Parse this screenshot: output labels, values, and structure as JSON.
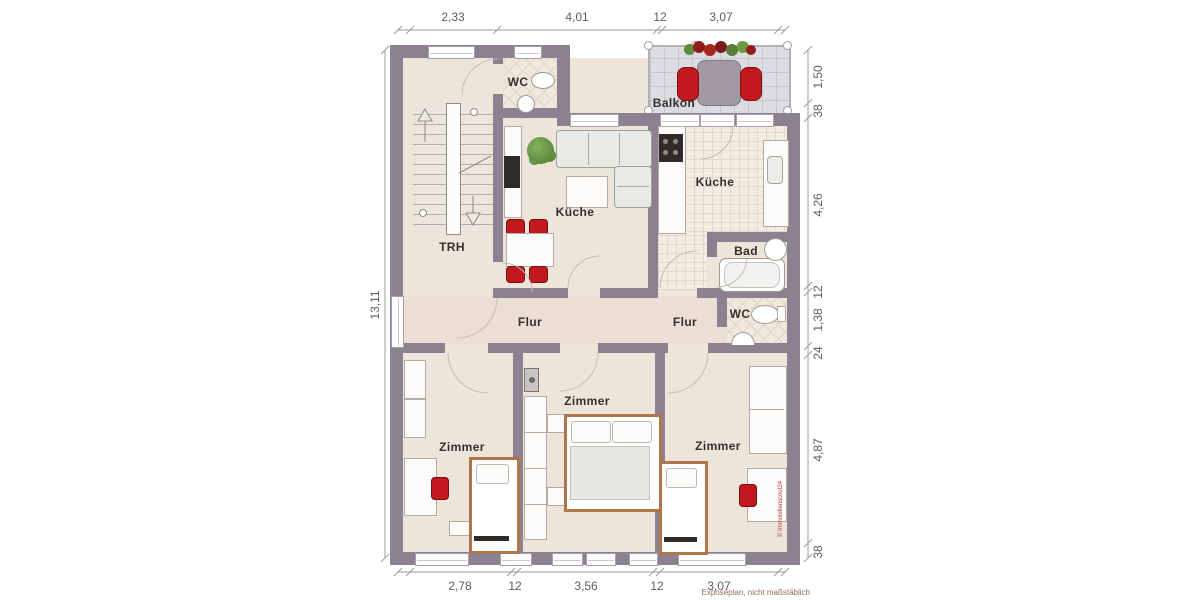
{
  "plan": {
    "rooms": {
      "balkon": "Balkon",
      "wc_top": "WC",
      "kueche_left": "Küche",
      "kueche_right": "Küche",
      "bad": "Bad",
      "trh": "TRH",
      "flur_left": "Flur",
      "flur_right": "Flur",
      "wc_mid": "WC",
      "zimmer_left": "Zimmer",
      "zimmer_mid": "Zimmer",
      "zimmer_right": "Zimmer"
    },
    "dims": {
      "top": [
        "2,33",
        "4,01",
        "12",
        "3,07"
      ],
      "right": [
        "1,50",
        "38",
        "4,26",
        "12",
        "1,38",
        "24",
        "4,87",
        "38"
      ],
      "left": [
        "13,11"
      ],
      "bottom": [
        "2,78",
        "12",
        "3,56",
        "12",
        "3,07"
      ]
    },
    "note": "Exposéplan, nicht maßstäblich",
    "watermark": "© Immobilienscout24",
    "colors": {
      "wall": "#8c8191",
      "floor": "#eee5da",
      "tile": "#f3ece2",
      "balcony": "#dddce1",
      "accent_red": "#c2191e",
      "bed_frame": "#ad774b"
    }
  }
}
